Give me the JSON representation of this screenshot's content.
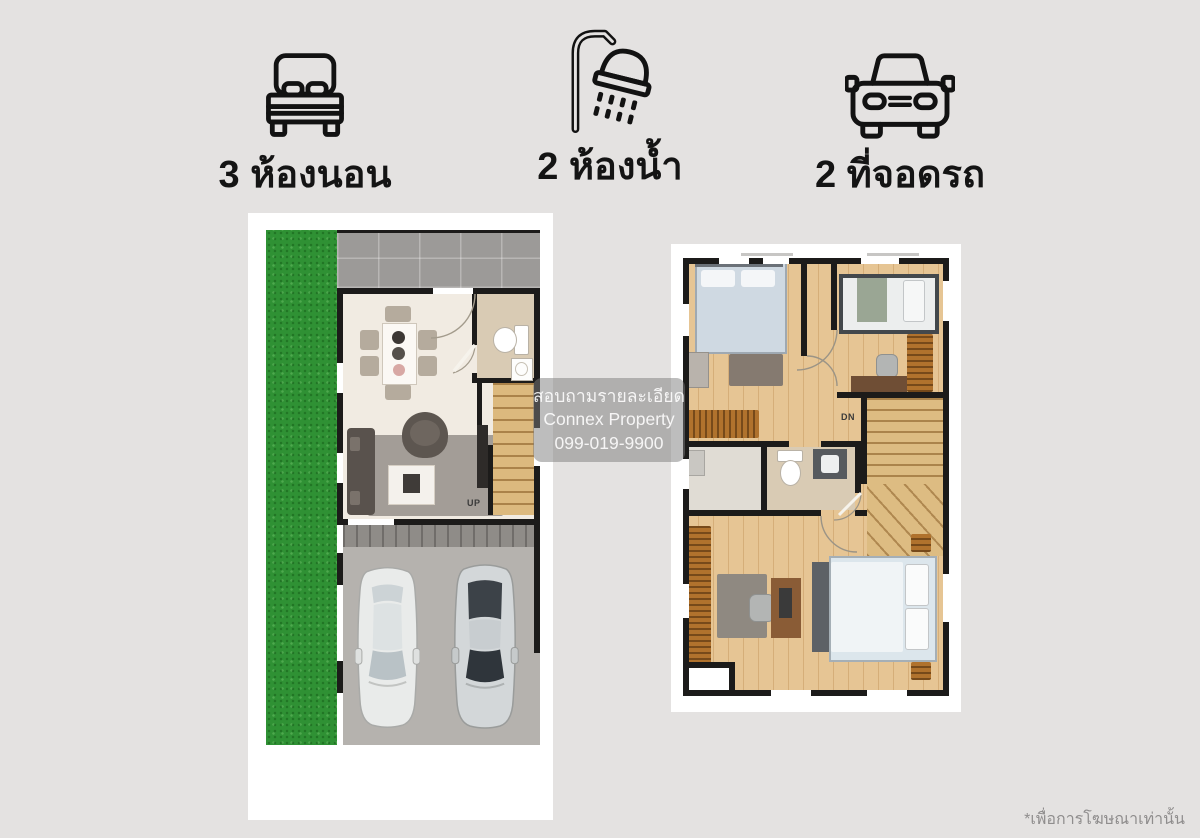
{
  "page": {
    "background_color": "#e4e2e1",
    "card_color": "#ffffff",
    "accent_wall_color": "#1c1b1a",
    "grass_color": "#2f9134",
    "wood_floor_color": "#e6c594"
  },
  "features": [
    {
      "id": "bedrooms",
      "icon": "bed-icon",
      "label": "3 ห้องนอน"
    },
    {
      "id": "bathrooms",
      "icon": "shower-icon",
      "label": "2 ห้องน้ำ"
    },
    {
      "id": "parking",
      "icon": "car-icon",
      "label": "2 ที่จอดรถ"
    }
  ],
  "watermark": {
    "line1": "สอบถามรายละเอียด",
    "line2": "Connex Property",
    "line3": "099-019-9900"
  },
  "floorplans": {
    "first_floor": {
      "stairs_label": "UP"
    },
    "second_floor": {
      "stairs_label": "DN"
    }
  },
  "footer": {
    "note": "*เพื่อการโฆษณาเท่านั้น"
  }
}
